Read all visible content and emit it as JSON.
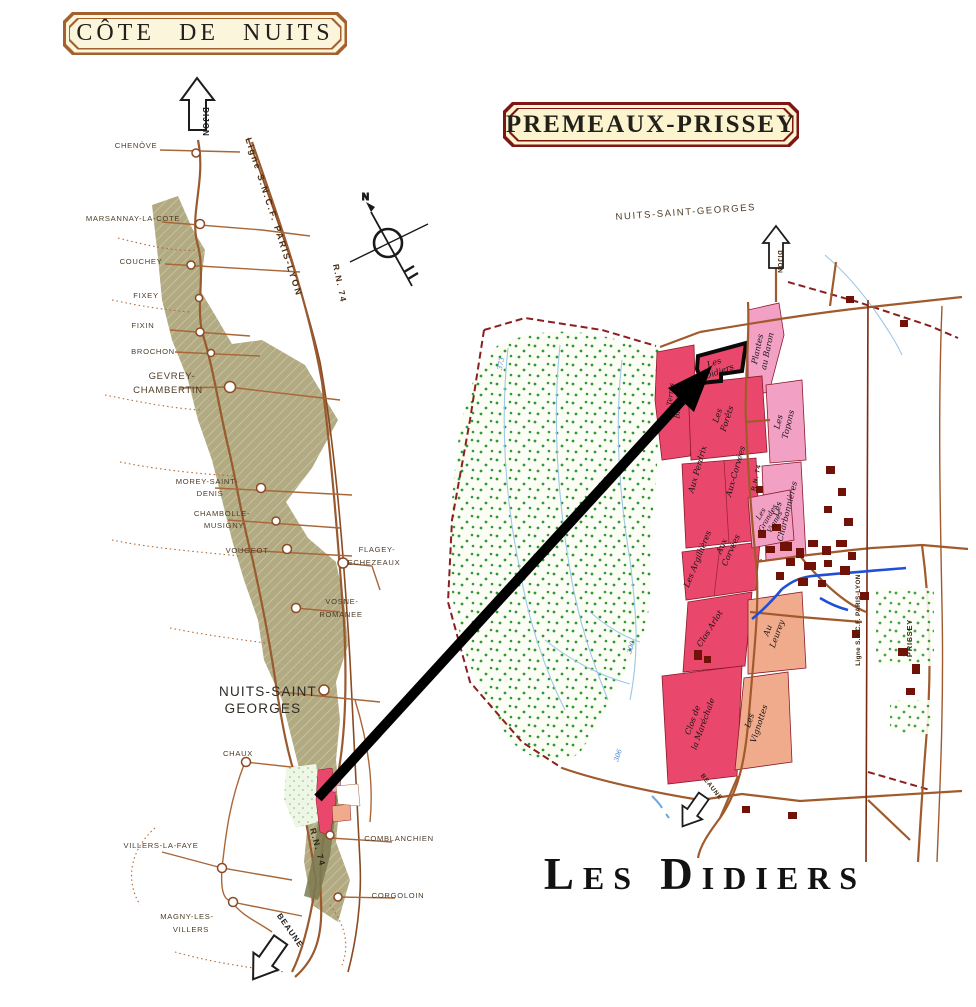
{
  "titles": {
    "left_box": "CÔTE DE NUITS",
    "right_box": "PREMEAUX-PRISSEY"
  },
  "caption": "Les Didiers",
  "compass_n": "N",
  "left_map": {
    "arrow_top": "DIJON",
    "arrow_bottom": "BEAUNE",
    "railway_label": "Ligne S.N.C.F. PARIS-LYON",
    "rn74_top": "R.N. 74",
    "rn74_bottom": "R.N. 74",
    "villages": [
      {
        "lines": [
          "CHENÔVE"
        ]
      },
      {
        "lines": [
          "MARSANNAY-LA-COTE"
        ]
      },
      {
        "lines": [
          "COUCHEY"
        ]
      },
      {
        "lines": [
          "FIXEY"
        ]
      },
      {
        "lines": [
          "FIXIN"
        ]
      },
      {
        "lines": [
          "BROCHON"
        ]
      },
      {
        "lines": [
          "GEVREY-",
          "CHAMBERTIN"
        ]
      },
      {
        "lines": [
          "MOREY-SAINT-",
          "DENIS"
        ]
      },
      {
        "lines": [
          "CHAMBOLLE-",
          "MUSIGNY"
        ]
      },
      {
        "lines": [
          "VOUGEOT"
        ]
      },
      {
        "lines": [
          "FLAGEY-",
          "ECHEZEAUX"
        ]
      },
      {
        "lines": [
          "VOSNE-",
          "ROMANEE"
        ]
      },
      {
        "lines": [
          "NUITS-SAINT",
          "GEORGES"
        ]
      },
      {
        "lines": [
          "CHAUX"
        ]
      },
      {
        "lines": [
          "VILLERS-LA-FAYE"
        ]
      },
      {
        "lines": [
          "MAGNY-LES-",
          "VILLERS"
        ]
      },
      {
        "lines": [
          "COMBLANCHIEN"
        ]
      },
      {
        "lines": [
          "CORGOLOIN"
        ]
      }
    ]
  },
  "right_map": {
    "top_label": "NUITS-SAINT-GEORGES",
    "arrow_top": "DIJON",
    "arrow_bottom": "BEAUNE",
    "railway_label": "Ligne S.N.C.F. PARIS-LYON",
    "prissey_label": "PRISSEY",
    "rn74": "R.N. 74",
    "contours": [
      "373",
      "300",
      "306"
    ],
    "plots": [
      {
        "lines": [
          "Les",
          "Didiers"
        ]
      },
      {
        "lines": [
          "Plantes",
          "au Baron"
        ]
      },
      {
        "lines": [
          "Les",
          "Forêts"
        ]
      },
      {
        "lines": [
          "Les",
          "Topons"
        ]
      },
      {
        "lines": [
          "Les",
          "Charbonnières"
        ]
      },
      {
        "lines": [
          "Aux Perdrix"
        ]
      },
      {
        "lines": [
          "Aux-Corvées"
        ]
      },
      {
        "lines": [
          "Les Argillières"
        ]
      },
      {
        "lines": [
          "Aux",
          "Corvées"
        ]
      },
      {
        "lines": [
          "Les",
          "Grandes",
          "Vignes"
        ]
      },
      {
        "lines": [
          "Les Terres",
          "Blanches"
        ]
      },
      {
        "lines": [
          "Clos Arlot"
        ]
      },
      {
        "lines": [
          "Au",
          "Leurey"
        ]
      },
      {
        "lines": [
          "Clos de",
          "la Maréchale"
        ]
      },
      {
        "lines": [
          "Les",
          "Vignottes"
        ]
      }
    ]
  }
}
